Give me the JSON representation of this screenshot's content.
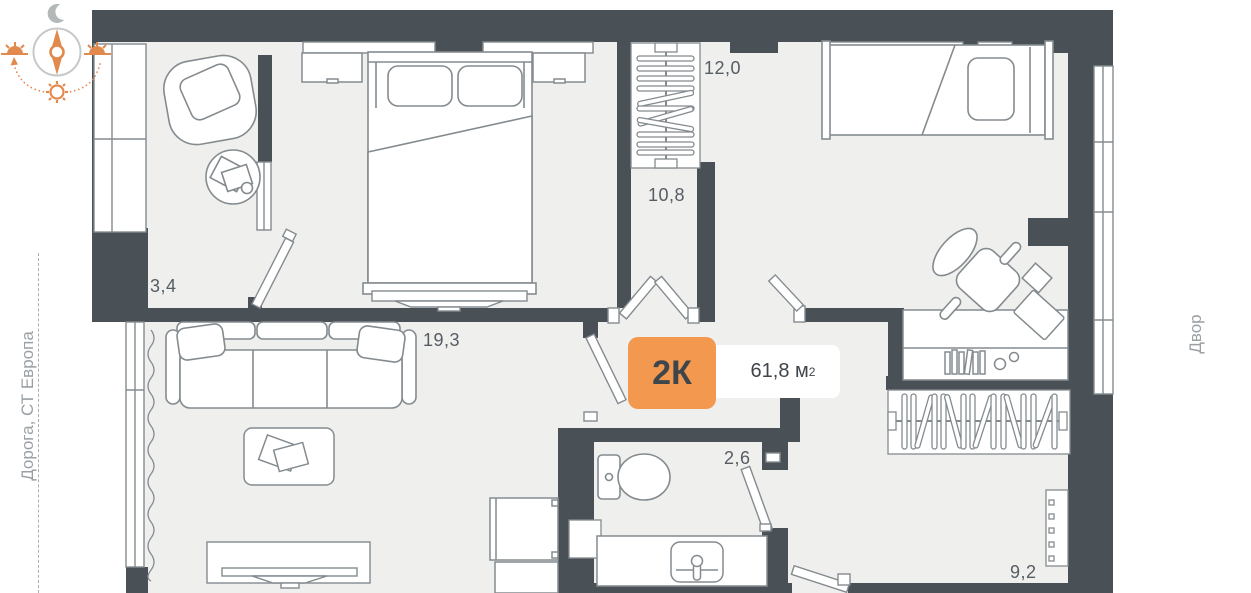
{
  "floor_plan": {
    "badge": {
      "rooms_label": "2К",
      "area_value": "61,8 м",
      "area_sup": "2"
    },
    "room_areas": {
      "balcony": "3,4",
      "bedroom": "12,0",
      "hallway": "10,8",
      "living_room": "19,3",
      "bathroom": "2,6",
      "kitchen": "9,2"
    }
  },
  "surroundings": {
    "left_label": "Дорога, СТ Европа",
    "right_label": "Двор"
  },
  "icons": {
    "moon": "crescent-moon",
    "compass_needle": "north-south-needle",
    "sunrise": "sun-at-horizon-left",
    "sunset": "sun-at-horizon-right",
    "noon_sun": "sun",
    "sun_path": "dotted-arc"
  },
  "colors": {
    "wall": "#4a5156",
    "floor": "#efefee",
    "line": "#848b8f",
    "accent_orange": "#f2984f",
    "label_text": "#565d62",
    "muted_text": "#9aa0a4"
  }
}
